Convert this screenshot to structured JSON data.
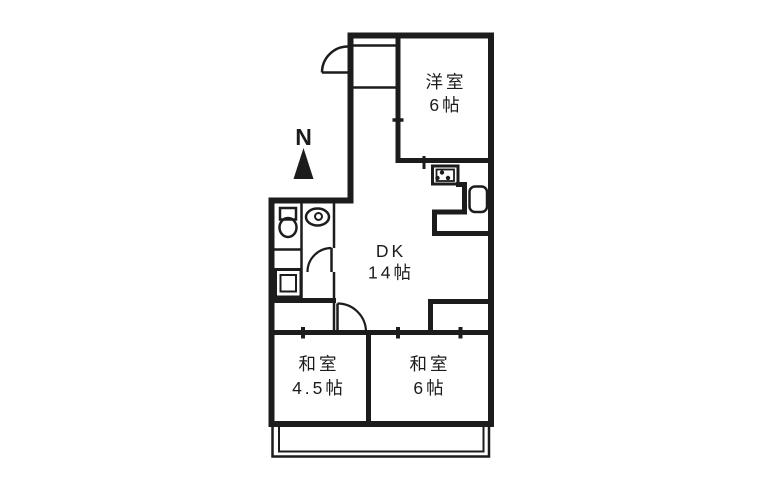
{
  "compass": {
    "label": "N"
  },
  "rooms": {
    "western": {
      "name": "洋室",
      "size": "6帖"
    },
    "dk": {
      "name": "DK",
      "size": "14帖"
    },
    "japanese_small": {
      "name": "和室",
      "size": "4.5帖"
    },
    "japanese_large": {
      "name": "和室",
      "size": "6帖"
    }
  },
  "icons": {
    "compass_north": "▲",
    "stove": "rect-with-3-burner-dots",
    "kitchen_sink": "rounded-rect",
    "toilet": "tank-and-bowl",
    "vanity_sink": "oval-with-drain",
    "washer_pan": "double-square",
    "doors": "quarter-arc-swing"
  },
  "colors": {
    "line": "#1c1c1c",
    "background": "#ffffff"
  }
}
